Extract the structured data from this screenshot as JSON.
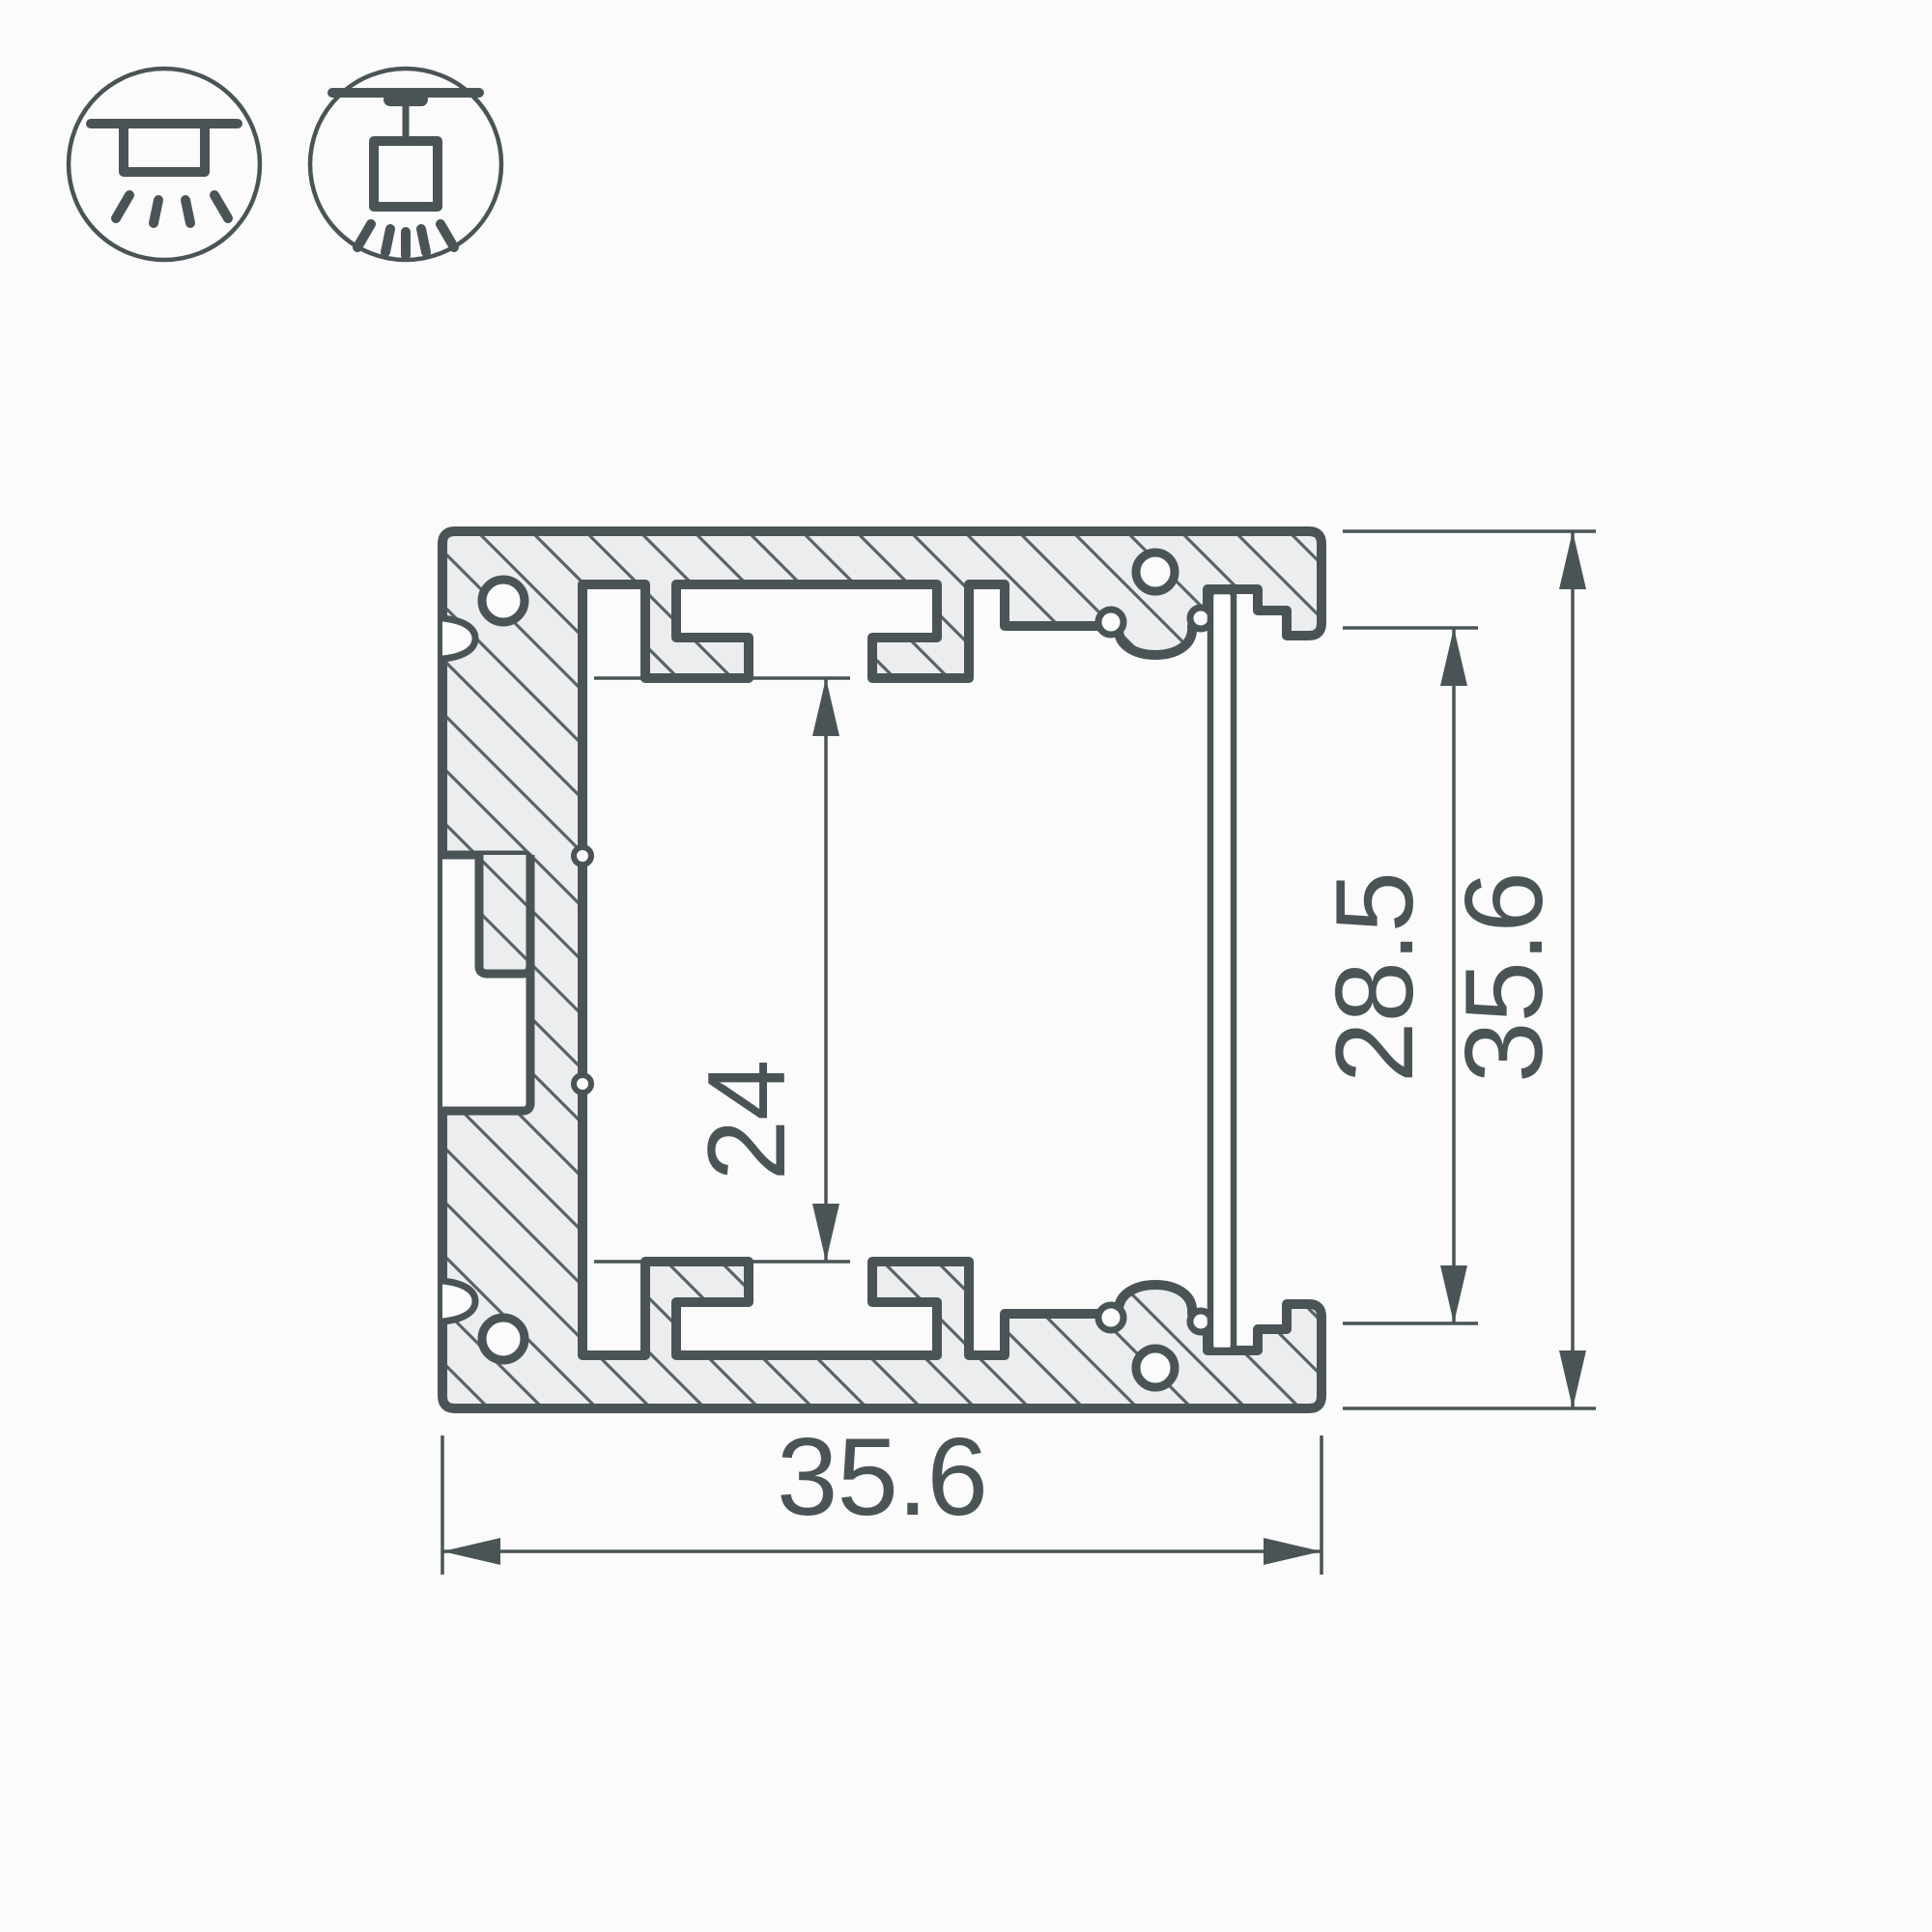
{
  "drawing": {
    "type": "aluminum-profile-cross-section",
    "dimensions": {
      "cavity_height": "24",
      "opening_height": "28.5",
      "overall_height": "35.6",
      "overall_width": "35.6"
    },
    "icons": {
      "first": "surface-mount-light-icon",
      "second": "pendant-mount-light-icon"
    },
    "colors": {
      "line": "#4A5456",
      "hatch_fill": "#ECEDEE",
      "hatch_line": "#5A6365",
      "diffuser_fill": "#FDFDFD",
      "background": "#FBFBFB"
    }
  }
}
